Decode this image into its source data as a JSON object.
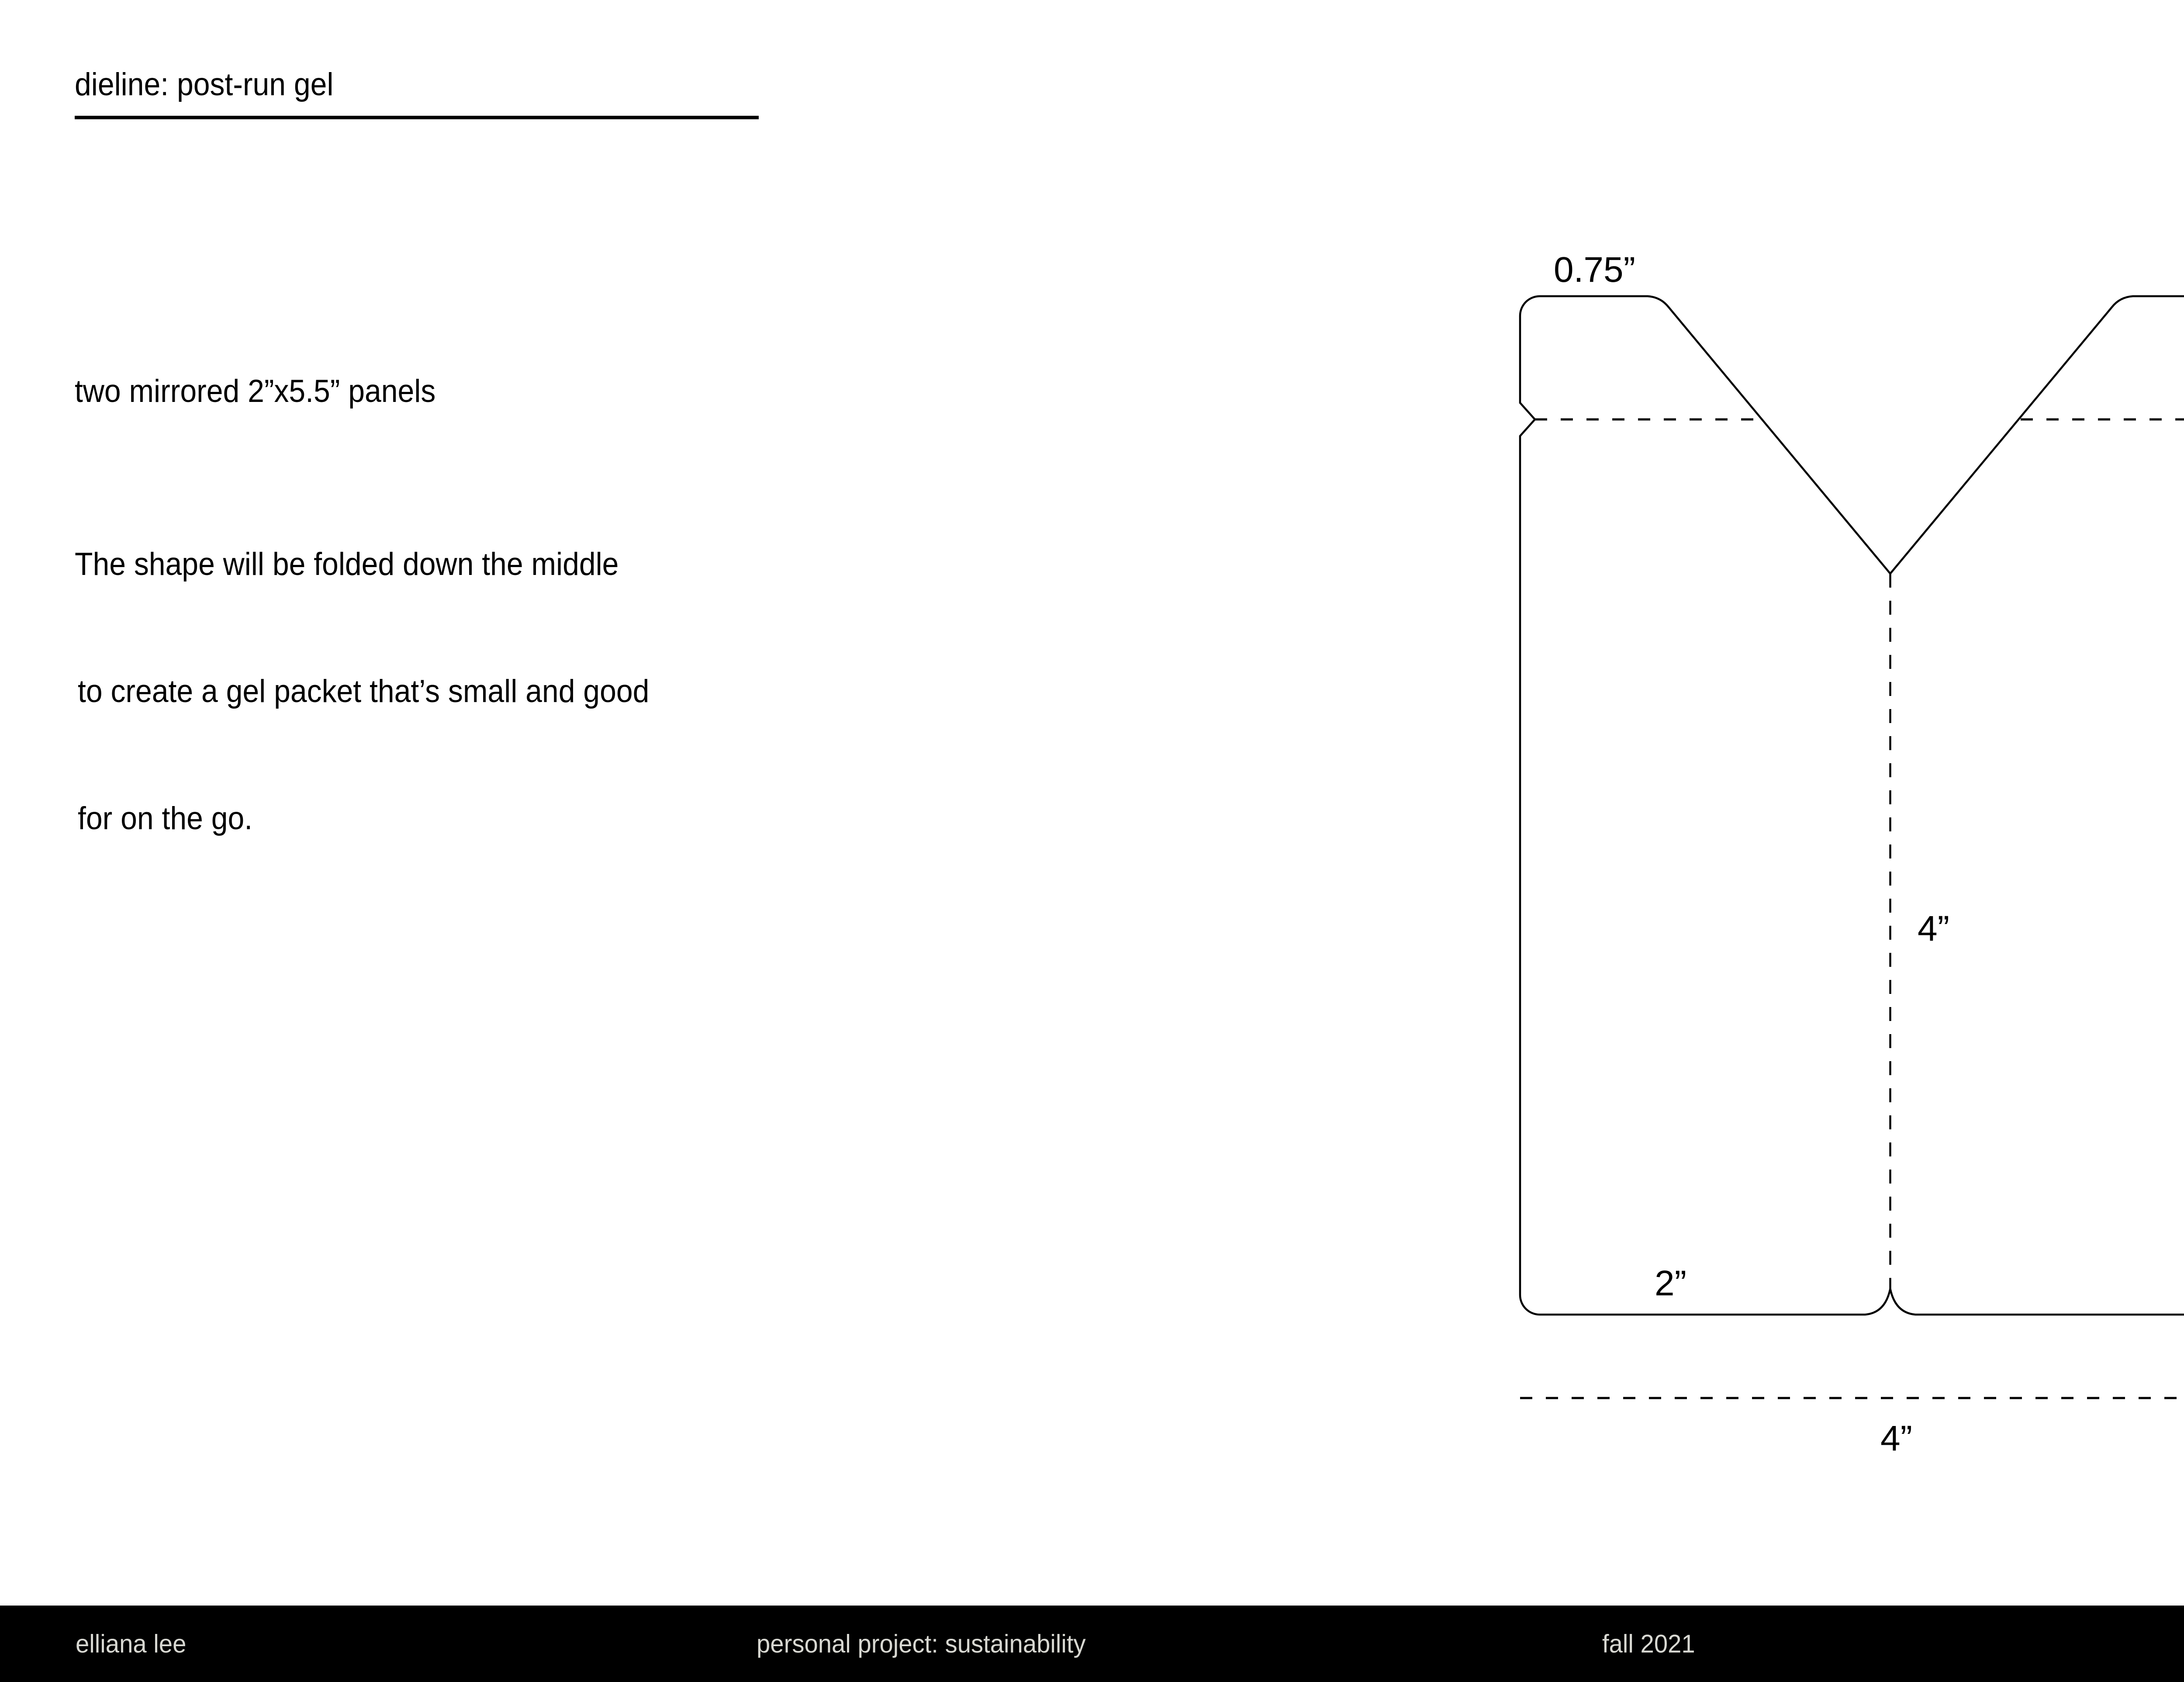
{
  "header": {
    "title": "dieline: post-run gel"
  },
  "left_text": {
    "intro": "two mirrored 2”x5.5” panels",
    "body_lines": [
      "The shape will be folded down the middle",
      "to create a gel packet that’s small and good",
      "for on the go."
    ]
  },
  "diagram": {
    "labels": {
      "flap_height": "0.75”",
      "center_height": "4”",
      "total_height": "5.5”",
      "panel_width": "2”",
      "total_width": "4”"
    },
    "line_color": "#000000"
  },
  "footer": {
    "author": "elliana lee",
    "project": "personal project: sustainability",
    "term": "fall 2021",
    "course": "packaging design 1: jini zopf"
  },
  "colors": {
    "background": "#ffffff",
    "line": "#000000",
    "footer_bg": "#000000",
    "footer_text": "#d8d8d2"
  }
}
